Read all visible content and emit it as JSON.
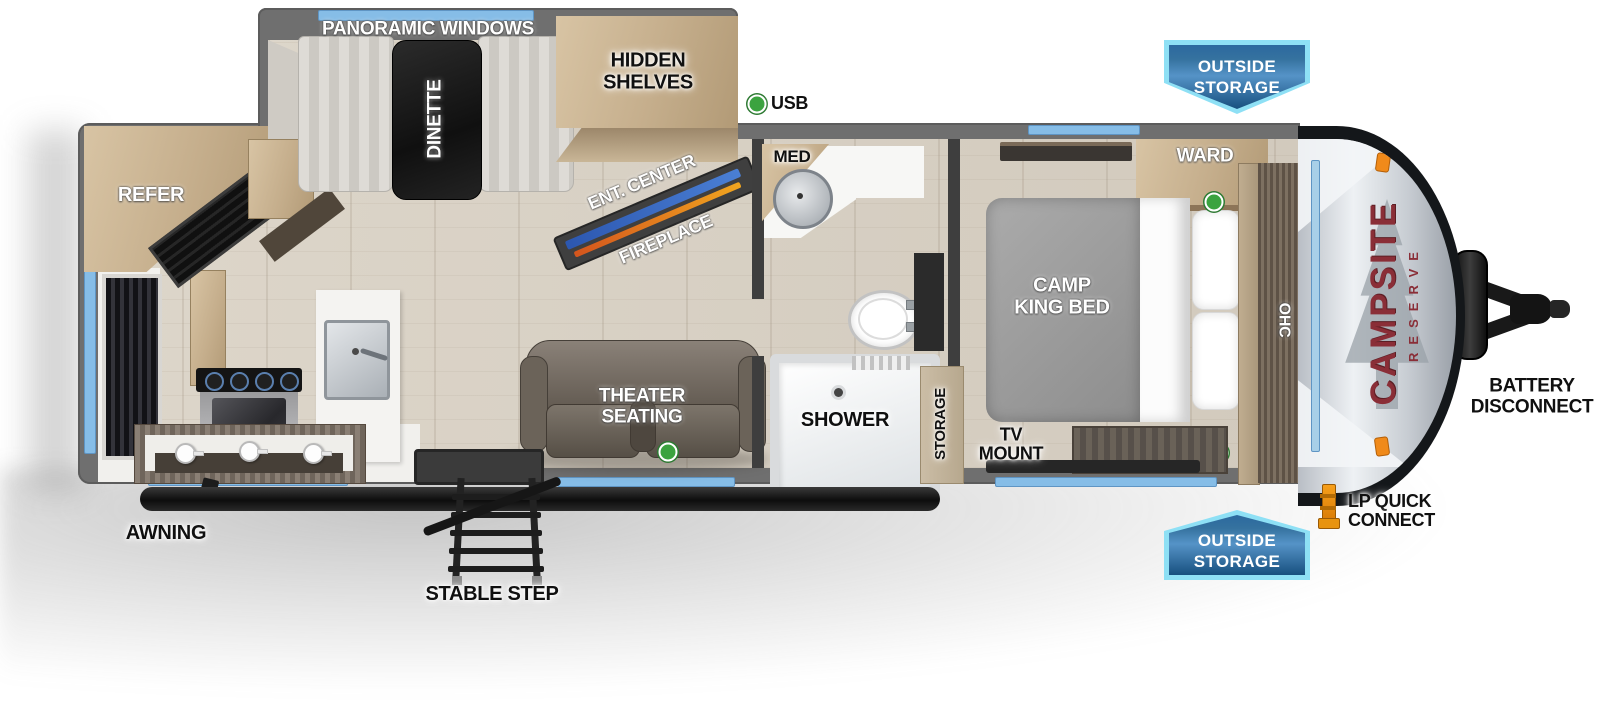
{
  "title": "Campsite Reserve travel trailer floorplan",
  "brand": {
    "name": "CAMPSITE",
    "series": "RESERVE"
  },
  "labels": {
    "panoramic_windows": "PANORAMIC WINDOWS",
    "dinette": "DINETTE",
    "hidden1": "HIDDEN",
    "hidden2": "SHELVES",
    "ent_center": "ENT. CENTER",
    "fireplace": "FIREPLACE",
    "usb": "USB",
    "med": "MED",
    "ward": "WARD",
    "bed1": "CAMP",
    "bed2": "KING BED",
    "ohc": "OHC",
    "refer": "REFER",
    "theater1": "THEATER",
    "theater2": "SEATING",
    "shower": "SHOWER",
    "storage": "STORAGE",
    "tv1": "TV",
    "tv2": "MOUNT",
    "awning": "AWNING",
    "stable_step": "STABLE STEP",
    "battery1": "BATTERY",
    "battery2": "DISCONNECT",
    "lp1": "LP QUICK",
    "lp2": "CONNECT"
  },
  "badge": {
    "line1": "OUTSIDE",
    "line2": "STORAGE"
  },
  "colors": {
    "window_blue": "#86bde7",
    "badge_fill": "#2c699f",
    "badge_border": "#8ee0f5",
    "logo_maroon": "#8a2e37",
    "usb_dot_green": "#3ba33f",
    "wall_gray": "#6f6f6f",
    "floor_wood": "#d8d1c5",
    "cabinet_wood": "#c5ae8c",
    "clearance_orange": "#f08a1a"
  }
}
